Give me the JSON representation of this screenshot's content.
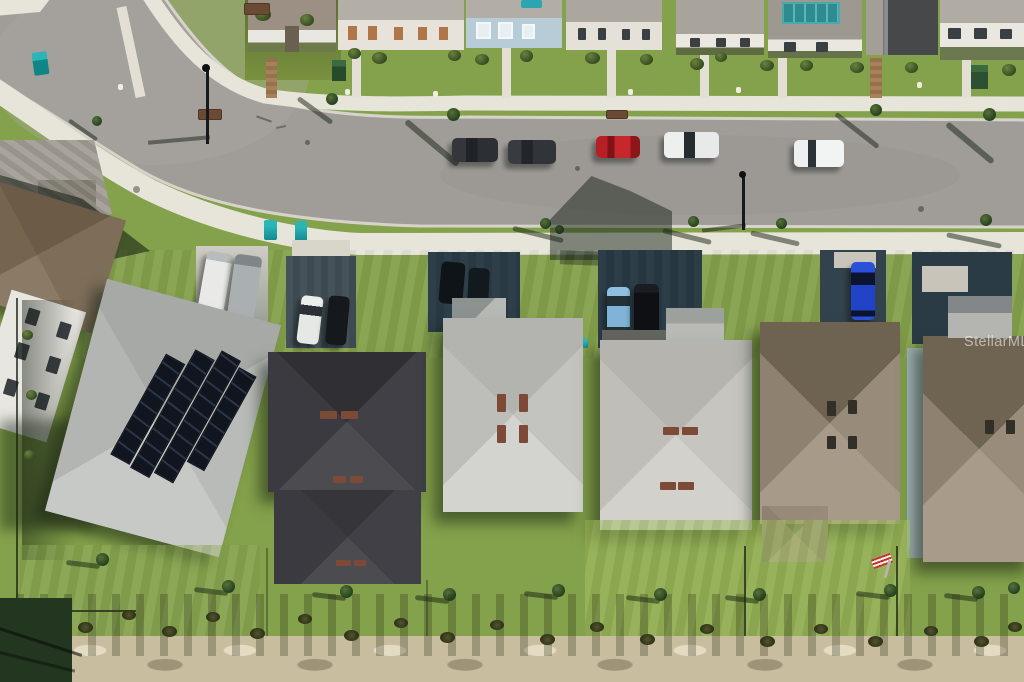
{
  "watermark": {
    "text": "StellarMLS"
  },
  "scene": {
    "description": "Overhead aerial drone photo of a suburban residential street with rows of single-family homes",
    "palette": {
      "asphalt": "#a09d99",
      "curb": "#d6d3ca",
      "sidewalk": "#e7e4da",
      "sunlit_lawn": "#8aa750",
      "shadow_lawn": "#2c4526",
      "sand": "#c9bd9f",
      "light_gray_roof": "#c6c7c3",
      "charcoal_roof": "#3e3e44",
      "brown_roof": "#9d9081",
      "teal_accent": "#17989c",
      "solar_panel": "#141a24"
    },
    "street_parked_cars": [
      {
        "color": "#26282c",
        "label": "dark car"
      },
      {
        "color": "#2b2e33",
        "label": "dark gray car"
      },
      {
        "color": "#c22427",
        "label": "red car"
      },
      {
        "color": "#eef0f0",
        "label": "white car with dark glass"
      },
      {
        "color": "#f0f2f2",
        "label": "white car"
      }
    ],
    "driveway_vehicles": [
      {
        "color": "#e9eae8",
        "label": "white van"
      },
      {
        "color": "#aab0b2",
        "label": "gray van"
      },
      {
        "color": "#eceeec",
        "label": "white car"
      },
      {
        "color": "#15181c",
        "label": "dark car"
      },
      {
        "color": "#7fb3d8",
        "label": "light blue car"
      },
      {
        "color": "#101216",
        "label": "black suv"
      },
      {
        "color": "#2043c8",
        "label": "bright blue car"
      },
      {
        "color": "#2e8f9c",
        "label": "teal car"
      }
    ],
    "bottom_houses": [
      {
        "roof": "light gray",
        "feature": "rooftop solar array"
      },
      {
        "roof": "dark charcoal",
        "feature": "two hip sections"
      },
      {
        "roof": "light gray",
        "feature": "four ridge vents"
      },
      {
        "roof": "light gray",
        "feature": "garage wing"
      },
      {
        "roof": "brown tan",
        "feature": "fenced backyard with flag"
      },
      {
        "roof": "brown tan",
        "feature": "partially visible at edge"
      }
    ],
    "top_row_features": [
      "light blue facade home",
      "tan shutter home",
      "teal rooftop solar panel",
      "two backyard pools",
      "charcoal two-story home"
    ],
    "street_furniture": [
      "two street lights",
      "two teal trash bins",
      "teal street sign",
      "storm drain grates",
      "manhole covers"
    ],
    "landscape": [
      "young street trees with long shadows",
      "backyard saplings",
      "scrub brush row",
      "bare sandy strip",
      "chain-link fences"
    ]
  }
}
